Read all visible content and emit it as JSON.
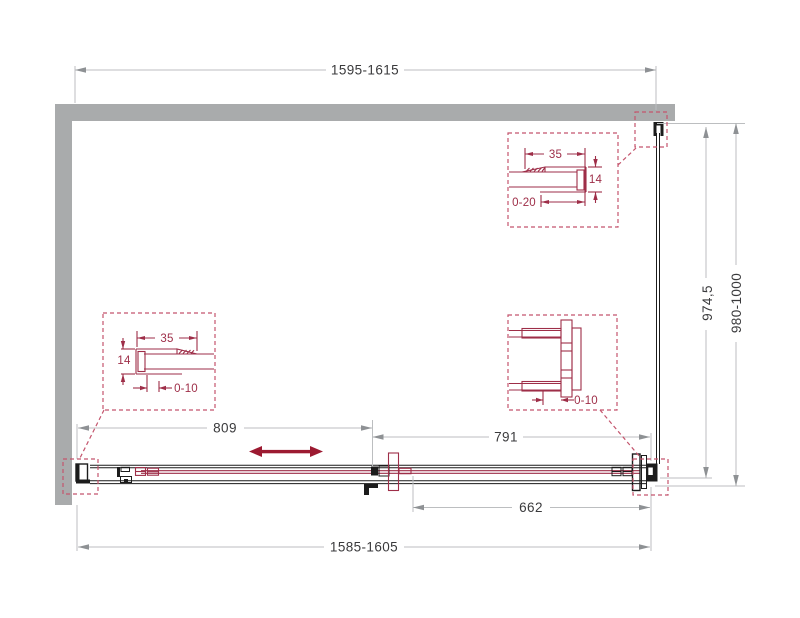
{
  "drawing_type": "shower-enclosure-sliding-door-technical-drawing",
  "dimensions": {
    "top_width": "1595-1615",
    "bottom_width": "1585-1605",
    "fixed_panel_width": "662",
    "door_opening_left": "809",
    "door_opening_right": "791",
    "side_glass_height": "974,5",
    "side_total_height": "980-1000"
  },
  "details": {
    "top_right": {
      "width": "35",
      "height": "14",
      "adjustment": "0-20"
    },
    "middle_left": {
      "width": "35",
      "height": "14",
      "adjustment": "0-10"
    },
    "middle_right": {
      "adjustment": "0-10"
    }
  },
  "colors": {
    "wall": "#a9abac",
    "outline": "#1c1c1c",
    "detail_red": "#9e2e48",
    "dashed_red": "#c4556d",
    "dim_line": "#bcbec0",
    "dim_arrow": "#8e9194",
    "dim_text": "#3a3a3c",
    "slide_arrow": "#9c1a31"
  }
}
